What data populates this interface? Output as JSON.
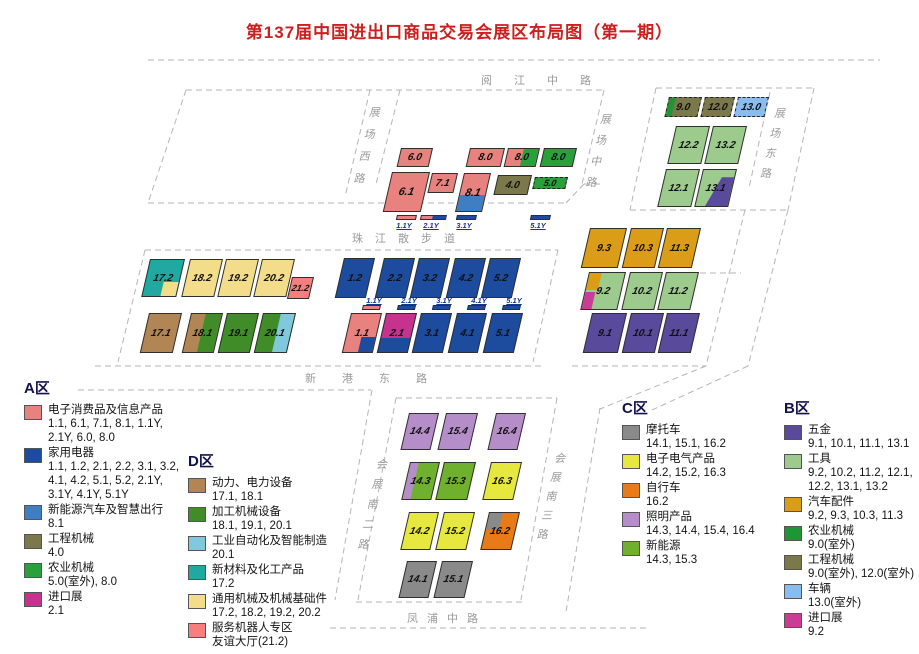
{
  "title": {
    "text": "第137届中国进出口商品交易会展区布局图（第一期）"
  },
  "palette": {
    "pink": "#E8827E",
    "darkblue": "#1D4B9E",
    "medblue": "#3F7EC2",
    "olive": "#7B794B",
    "green": "#2AA03C",
    "magenta": "#C5338F",
    "purple": "#5A4A9C",
    "lightgreen": "#9DCA8D",
    "gold": "#DB9D17",
    "bgreen": "#1E9636",
    "lightblue": "#8ABDEF",
    "bmagenta": "#C93D97",
    "gray": "#8A8A8A",
    "yellow": "#E6E73F",
    "orange": "#E87B18",
    "lilac": "#B58DC9",
    "cgreen": "#6FB02E",
    "brown": "#B18654",
    "dgreen": "#3F8C28",
    "dlightblue": "#80C9DD",
    "teal": "#1FA9A0",
    "lightyellow": "#F3DD8B",
    "salmon": "#F57F7E"
  },
  "roads": [
    {
      "id": "yuejiang-middle-road",
      "label": "阅江中路",
      "x": 481,
      "y": 72,
      "dir": "h",
      "ls": 22
    },
    {
      "id": "zhanchang-west-road",
      "label": "展场西路",
      "x": 371,
      "y": 102,
      "dir": "v",
      "lh": 22
    },
    {
      "id": "zhanchang-middle-road",
      "label": "展场中路",
      "x": 602,
      "y": 110,
      "dir": "v",
      "lh": 21
    },
    {
      "id": "zhanchang-east-road",
      "label": "展场东路",
      "x": 776,
      "y": 104,
      "dir": "v",
      "lh": 20
    },
    {
      "id": "zhujiang-promenade",
      "label": "珠江散步道",
      "x": 352,
      "y": 230,
      "dir": "h",
      "ls": 12
    },
    {
      "id": "xingang-east-road",
      "label": "新港东路",
      "x": 305,
      "y": 370,
      "dir": "h",
      "ls": 26
    },
    {
      "id": "huizhan-south-2nd-road",
      "label": "会展南二路",
      "x": 378,
      "y": 455,
      "dir": "v",
      "lh": 20
    },
    {
      "id": "huizhan-south-3rd-road",
      "label": "会展南三路",
      "x": 556,
      "y": 450,
      "dir": "v",
      "lh": 19
    },
    {
      "id": "fengpu-middle-road",
      "label": "凤浦中路",
      "x": 407,
      "y": 610,
      "dir": "h",
      "ls": 9
    }
  ],
  "road_lines": [
    [
      148,
      60,
      880,
      60
    ],
    [
      186,
      90,
      604,
      90
    ],
    [
      186,
      90,
      148,
      203
    ],
    [
      148,
      203,
      566,
      203
    ],
    [
      604,
      90,
      582,
      184
    ],
    [
      566,
      203,
      584,
      184
    ],
    [
      584,
      184,
      602,
      184
    ],
    [
      370,
      90,
      345,
      197
    ],
    [
      400,
      90,
      376,
      184
    ],
    [
      656,
      88,
      630,
      210
    ],
    [
      656,
      88,
      814,
      88
    ],
    [
      814,
      88,
      788,
      210
    ],
    [
      630,
      210,
      788,
      210
    ],
    [
      770,
      92,
      749,
      188
    ],
    [
      788,
      210,
      748,
      366
    ],
    [
      745,
      210,
      706,
      366
    ],
    [
      700,
      273,
      741,
      273
    ],
    [
      145,
      250,
      558,
      250
    ],
    [
      145,
      250,
      118,
      362
    ],
    [
      95,
      366,
      545,
      366
    ],
    [
      558,
      250,
      533,
      362
    ],
    [
      78,
      390,
      371,
      390
    ],
    [
      396,
      398,
      557,
      398
    ],
    [
      396,
      398,
      358,
      600
    ],
    [
      372,
      390,
      335,
      600
    ],
    [
      557,
      398,
      521,
      600
    ],
    [
      600,
      408,
      566,
      612
    ],
    [
      356,
      602,
      522,
      602
    ],
    [
      330,
      628,
      650,
      628
    ],
    [
      572,
      366,
      706,
      366
    ],
    [
      706,
      366,
      600,
      409
    ],
    [
      748,
      366,
      652,
      410
    ]
  ],
  "halls": [
    {
      "id": "6.0",
      "x": 401,
      "y": 148,
      "w": 32,
      "h": 19,
      "base": "pink"
    },
    {
      "id": "8.0",
      "x": 470,
      "y": 148,
      "w": 35,
      "h": 19,
      "base": "pink"
    },
    {
      "id": "8.0",
      "x": 508,
      "y": 148,
      "w": 32,
      "h": 19,
      "base": "pink",
      "layers": [
        {
          "c": "green",
          "l": 50,
          "t": 0,
          "w": 50,
          "h": 100
        }
      ]
    },
    {
      "id": "8.0",
      "x": 544,
      "y": 148,
      "w": 33,
      "h": 19,
      "base": "green"
    },
    {
      "id": "6.1",
      "x": 392,
      "y": 172,
      "w": 38,
      "h": 40,
      "base": "pink",
      "fs": 11
    },
    {
      "id": "7.1",
      "x": 432,
      "y": 173,
      "w": 26,
      "h": 20,
      "base": "pink"
    },
    {
      "id": "8.1",
      "x": 464,
      "y": 173,
      "w": 27,
      "h": 39,
      "base": "pink",
      "fs": 11,
      "layers": [
        {
          "c": "medblue",
          "l": 0,
          "t": 58,
          "w": 100,
          "h": 42
        }
      ]
    },
    {
      "id": "4.0",
      "x": 498,
      "y": 175,
      "w": 34,
      "h": 20,
      "base": "olive"
    },
    {
      "id": "5.0",
      "x": 535,
      "y": 177,
      "w": 33,
      "h": 12,
      "base": "green",
      "dashed": true,
      "fs": 9
    },
    {
      "id": "1.1Y",
      "x": 397,
      "y": 215,
      "w": 20,
      "h": 5,
      "base": "pink",
      "bar": true,
      "labelPos": "below"
    },
    {
      "id": "2.1Y",
      "x": 421,
      "y": 215,
      "w": 26,
      "h": 5,
      "base": "pink",
      "bar": true,
      "labelPos": "below",
      "layers": [
        {
          "c": "darkblue",
          "l": 45,
          "t": 0,
          "w": 55,
          "h": 100
        }
      ]
    },
    {
      "id": "3.1Y",
      "x": 457,
      "y": 215,
      "w": 20,
      "h": 5,
      "base": "darkblue",
      "bar": true,
      "labelPos": "below"
    },
    {
      "id": "5.1Y",
      "x": 531,
      "y": 215,
      "w": 20,
      "h": 5,
      "base": "darkblue",
      "bar": true,
      "labelPos": "below"
    },
    {
      "id": "9.0",
      "x": 669,
      "y": 97,
      "w": 33,
      "h": 20,
      "base": "olive",
      "dashed": true,
      "layers": [
        {
          "c": "bgreen",
          "l": 0,
          "t": 0,
          "w": 20,
          "h": 100
        }
      ]
    },
    {
      "id": "12.0",
      "x": 705,
      "y": 97,
      "w": 30,
      "h": 20,
      "base": "olive",
      "dashed": true
    },
    {
      "id": "13.0",
      "x": 738,
      "y": 97,
      "w": 31,
      "h": 20,
      "base": "lightblue",
      "dashed": true
    },
    {
      "id": "12.2",
      "x": 676,
      "y": 126,
      "w": 34,
      "h": 38,
      "base": "lightgreen"
    },
    {
      "id": "13.2",
      "x": 713,
      "y": 126,
      "w": 34,
      "h": 38,
      "base": "lightgreen"
    },
    {
      "id": "12.1",
      "x": 666,
      "y": 169,
      "w": 34,
      "h": 38,
      "base": "lightgreen"
    },
    {
      "id": "13.1",
      "x": 703,
      "y": 169,
      "w": 34,
      "h": 38,
      "base": "lightgreen",
      "layers": [
        {
          "c": "purple",
          "poly": "62% 20%, 100% 20%, 100% 100%, 30% 100%"
        }
      ]
    },
    {
      "id": "9.3",
      "x": 590,
      "y": 228,
      "w": 37,
      "h": 40,
      "base": "gold"
    },
    {
      "id": "10.3",
      "x": 631,
      "y": 228,
      "w": 33,
      "h": 40,
      "base": "gold"
    },
    {
      "id": "11.3",
      "x": 667,
      "y": 228,
      "w": 34,
      "h": 40,
      "base": "gold"
    },
    {
      "id": "9.2",
      "x": 589,
      "y": 272,
      "w": 37,
      "h": 38,
      "base": "lightgreen",
      "layers": [
        {
          "c": "gold",
          "l": 0,
          "t": 0,
          "w": 33,
          "h": 46
        },
        {
          "c": "bmagenta",
          "l": 0,
          "t": 52,
          "w": 29,
          "h": 48
        }
      ]
    },
    {
      "id": "10.2",
      "x": 630,
      "y": 272,
      "w": 33,
      "h": 38,
      "base": "lightgreen"
    },
    {
      "id": "11.2",
      "x": 666,
      "y": 272,
      "w": 33,
      "h": 38,
      "base": "lightgreen"
    },
    {
      "id": "9.1",
      "x": 592,
      "y": 313,
      "w": 35,
      "h": 40,
      "base": "purple"
    },
    {
      "id": "10.1",
      "x": 631,
      "y": 313,
      "w": 33,
      "h": 40,
      "base": "purple"
    },
    {
      "id": "11.1",
      "x": 667,
      "y": 313,
      "w": 33,
      "h": 40,
      "base": "purple"
    },
    {
      "id": "17.2",
      "x": 150,
      "y": 259,
      "w": 35,
      "h": 38,
      "base": "teal",
      "layers": [
        {
          "c": "lightyellow",
          "l": 55,
          "t": 62,
          "w": 45,
          "h": 38
        }
      ]
    },
    {
      "id": "18.2",
      "x": 190,
      "y": 259,
      "w": 33,
      "h": 38,
      "base": "lightyellow"
    },
    {
      "id": "19.2",
      "x": 226,
      "y": 259,
      "w": 33,
      "h": 38,
      "base": "lightyellow"
    },
    {
      "id": "20.2",
      "x": 262,
      "y": 259,
      "w": 33,
      "h": 38,
      "base": "lightyellow"
    },
    {
      "id": "21.2",
      "x": 292,
      "y": 277,
      "w": 22,
      "h": 22,
      "base": "salmon",
      "fs": 9
    },
    {
      "id": "17.1",
      "x": 149,
      "y": 313,
      "w": 33,
      "h": 40,
      "base": "brown"
    },
    {
      "id": "18.1",
      "x": 191,
      "y": 313,
      "w": 32,
      "h": 40,
      "base": "brown",
      "layers": [
        {
          "c": "dgreen",
          "l": 48,
          "t": 0,
          "w": 52,
          "h": 100
        }
      ]
    },
    {
      "id": "19.1",
      "x": 227,
      "y": 313,
      "w": 32,
      "h": 40,
      "base": "dgreen"
    },
    {
      "id": "20.1",
      "x": 263,
      "y": 313,
      "w": 33,
      "h": 40,
      "base": "dgreen",
      "layers": [
        {
          "c": "dlightblue",
          "l": 56,
          "t": 0,
          "w": 44,
          "h": 100
        }
      ]
    },
    {
      "id": "1.2",
      "x": 344,
      "y": 258,
      "w": 31,
      "h": 40,
      "base": "darkblue"
    },
    {
      "id": "2.2",
      "x": 384,
      "y": 258,
      "w": 31,
      "h": 40,
      "base": "darkblue"
    },
    {
      "id": "3.2",
      "x": 419,
      "y": 258,
      "w": 31,
      "h": 40,
      "base": "darkblue"
    },
    {
      "id": "4.2",
      "x": 455,
      "y": 258,
      "w": 31,
      "h": 40,
      "base": "darkblue"
    },
    {
      "id": "5.2",
      "x": 490,
      "y": 258,
      "w": 31,
      "h": 40,
      "base": "darkblue"
    },
    {
      "id": "1.1Y",
      "x": 363,
      "y": 305,
      "w": 18,
      "h": 5,
      "base": "pink",
      "bar": true,
      "labelPos": "above"
    },
    {
      "id": "2.1Y",
      "x": 398,
      "y": 305,
      "w": 18,
      "h": 5,
      "base": "darkblue",
      "bar": true,
      "labelPos": "above"
    },
    {
      "id": "3.1Y",
      "x": 433,
      "y": 305,
      "w": 18,
      "h": 5,
      "base": "darkblue",
      "bar": true,
      "labelPos": "above"
    },
    {
      "id": "4.1Y",
      "x": 468,
      "y": 305,
      "w": 18,
      "h": 5,
      "base": "darkblue",
      "bar": true,
      "labelPos": "above"
    },
    {
      "id": "5.1Y",
      "x": 503,
      "y": 305,
      "w": 18,
      "h": 5,
      "base": "darkblue",
      "bar": true,
      "labelPos": "above"
    },
    {
      "id": "1.1",
      "x": 351,
      "y": 313,
      "w": 31,
      "h": 40,
      "base": "pink",
      "layers": [
        {
          "c": "darkblue",
          "l": 52,
          "t": 60,
          "w": 48,
          "h": 40
        }
      ]
    },
    {
      "id": "2.1",
      "x": 386,
      "y": 313,
      "w": 31,
      "h": 40,
      "base": "darkblue",
      "layers": [
        {
          "c": "magenta",
          "l": 0,
          "t": 0,
          "w": 100,
          "h": 62
        }
      ]
    },
    {
      "id": "3.1",
      "x": 421,
      "y": 313,
      "w": 31,
      "h": 40,
      "base": "darkblue"
    },
    {
      "id": "4.1",
      "x": 457,
      "y": 313,
      "w": 30,
      "h": 40,
      "base": "darkblue"
    },
    {
      "id": "5.1",
      "x": 492,
      "y": 313,
      "w": 31,
      "h": 40,
      "base": "darkblue"
    },
    {
      "id": "14.4",
      "x": 409,
      "y": 413,
      "w": 30,
      "h": 37,
      "base": "lilac"
    },
    {
      "id": "15.4",
      "x": 446,
      "y": 413,
      "w": 32,
      "h": 37,
      "base": "lilac"
    },
    {
      "id": "16.4",
      "x": 496,
      "y": 413,
      "w": 30,
      "h": 37,
      "base": "lilac"
    },
    {
      "id": "14.3",
      "x": 410,
      "y": 462,
      "w": 30,
      "h": 38,
      "base": "cgreen",
      "layers": [
        {
          "c": "lilac",
          "l": 0,
          "t": 0,
          "w": 28,
          "h": 100
        }
      ]
    },
    {
      "id": "15.3",
      "x": 444,
      "y": 462,
      "w": 32,
      "h": 38,
      "base": "cgreen"
    },
    {
      "id": "16.3",
      "x": 491,
      "y": 462,
      "w": 31,
      "h": 38,
      "base": "yellow"
    },
    {
      "id": "14.2",
      "x": 409,
      "y": 512,
      "w": 30,
      "h": 38,
      "base": "yellow"
    },
    {
      "id": "15.2",
      "x": 444,
      "y": 512,
      "w": 31,
      "h": 38,
      "base": "yellow"
    },
    {
      "id": "16.2",
      "x": 489,
      "y": 512,
      "w": 31,
      "h": 38,
      "base": "orange",
      "layers": [
        {
          "c": "gray",
          "l": 0,
          "t": 0,
          "w": 46,
          "h": 48
        }
      ]
    },
    {
      "id": "14.1",
      "x": 407,
      "y": 561,
      "w": 30,
      "h": 37,
      "base": "gray"
    },
    {
      "id": "15.1",
      "x": 442,
      "y": 561,
      "w": 31,
      "h": 37,
      "base": "gray"
    }
  ],
  "legends": [
    {
      "id": "A",
      "title": "A区",
      "x": 24,
      "y": 377,
      "entries": [
        {
          "color": "pink",
          "name": "电子消费品及信息产品",
          "halls": "1.1, 6.1, 7.1, 8.1, 1.1Y,\n2.1Y, 6.0, 8.0"
        },
        {
          "color": "darkblue",
          "name": "家用电器",
          "halls": "1.1, 1.2, 2.1, 2.2, 3.1, 3.2,\n4.1, 4.2, 5.1, 5.2, 2.1Y,\n3.1Y, 4.1Y, 5.1Y"
        },
        {
          "color": "medblue",
          "name": "新能源汽车及智慧出行",
          "halls": "8.1"
        },
        {
          "color": "olive",
          "name": "工程机械",
          "halls": "4.0"
        },
        {
          "color": "green",
          "name": "农业机械",
          "halls": "5.0(室外), 8.0"
        },
        {
          "color": "magenta",
          "name": "进口展",
          "halls": "2.1"
        }
      ]
    },
    {
      "id": "D",
      "title": "D区",
      "x": 188,
      "y": 450,
      "entries": [
        {
          "color": "brown",
          "name": "动力、电力设备",
          "halls": "17.1, 18.1"
        },
        {
          "color": "dgreen",
          "name": "加工机械设备",
          "halls": "18.1, 19.1, 20.1"
        },
        {
          "color": "dlightblue",
          "name": "工业自动化及智能制造",
          "halls": "20.1"
        },
        {
          "color": "teal",
          "name": "新材料及化工产品",
          "halls": "17.2"
        },
        {
          "color": "lightyellow",
          "name": "通用机械及机械基础件",
          "halls": "17.2, 18.2, 19.2, 20.2"
        },
        {
          "color": "salmon",
          "name": "服务机器人专区",
          "halls": "友谊大厅(21.2)"
        }
      ]
    },
    {
      "id": "C",
      "title": "C区",
      "x": 622,
      "y": 397,
      "entries": [
        {
          "color": "gray",
          "name": "摩托车",
          "halls": "14.1, 15.1, 16.2"
        },
        {
          "color": "yellow",
          "name": "电子电气产品",
          "halls": "14.2, 15.2, 16.3"
        },
        {
          "color": "orange",
          "name": "自行车",
          "halls": "16.2"
        },
        {
          "color": "lilac",
          "name": "照明产品",
          "halls": "14.3, 14.4, 15.4, 16.4"
        },
        {
          "color": "cgreen",
          "name": "新能源",
          "halls": "14.3, 15.3"
        }
      ]
    },
    {
      "id": "B",
      "title": "B区",
      "x": 784,
      "y": 397,
      "entries": [
        {
          "color": "purple",
          "name": "五金",
          "halls": "9.1, 10.1, 11.1, 13.1"
        },
        {
          "color": "lightgreen",
          "name": "工具",
          "halls": "9.2, 10.2, 11.2, 12.1,\n12.2, 13.1, 13.2"
        },
        {
          "color": "gold",
          "name": "汽车配件",
          "halls": "9.2, 9.3, 10.3, 11.3"
        },
        {
          "color": "bgreen",
          "name": "农业机械",
          "halls": "9.0(室外)"
        },
        {
          "color": "olive",
          "name": "工程机械",
          "halls": "9.0(室外), 12.0(室外)"
        },
        {
          "color": "lightblue",
          "name": "车辆",
          "halls": "13.0(室外)"
        },
        {
          "color": "bmagenta",
          "name": "进口展",
          "halls": "9.2"
        }
      ]
    }
  ]
}
